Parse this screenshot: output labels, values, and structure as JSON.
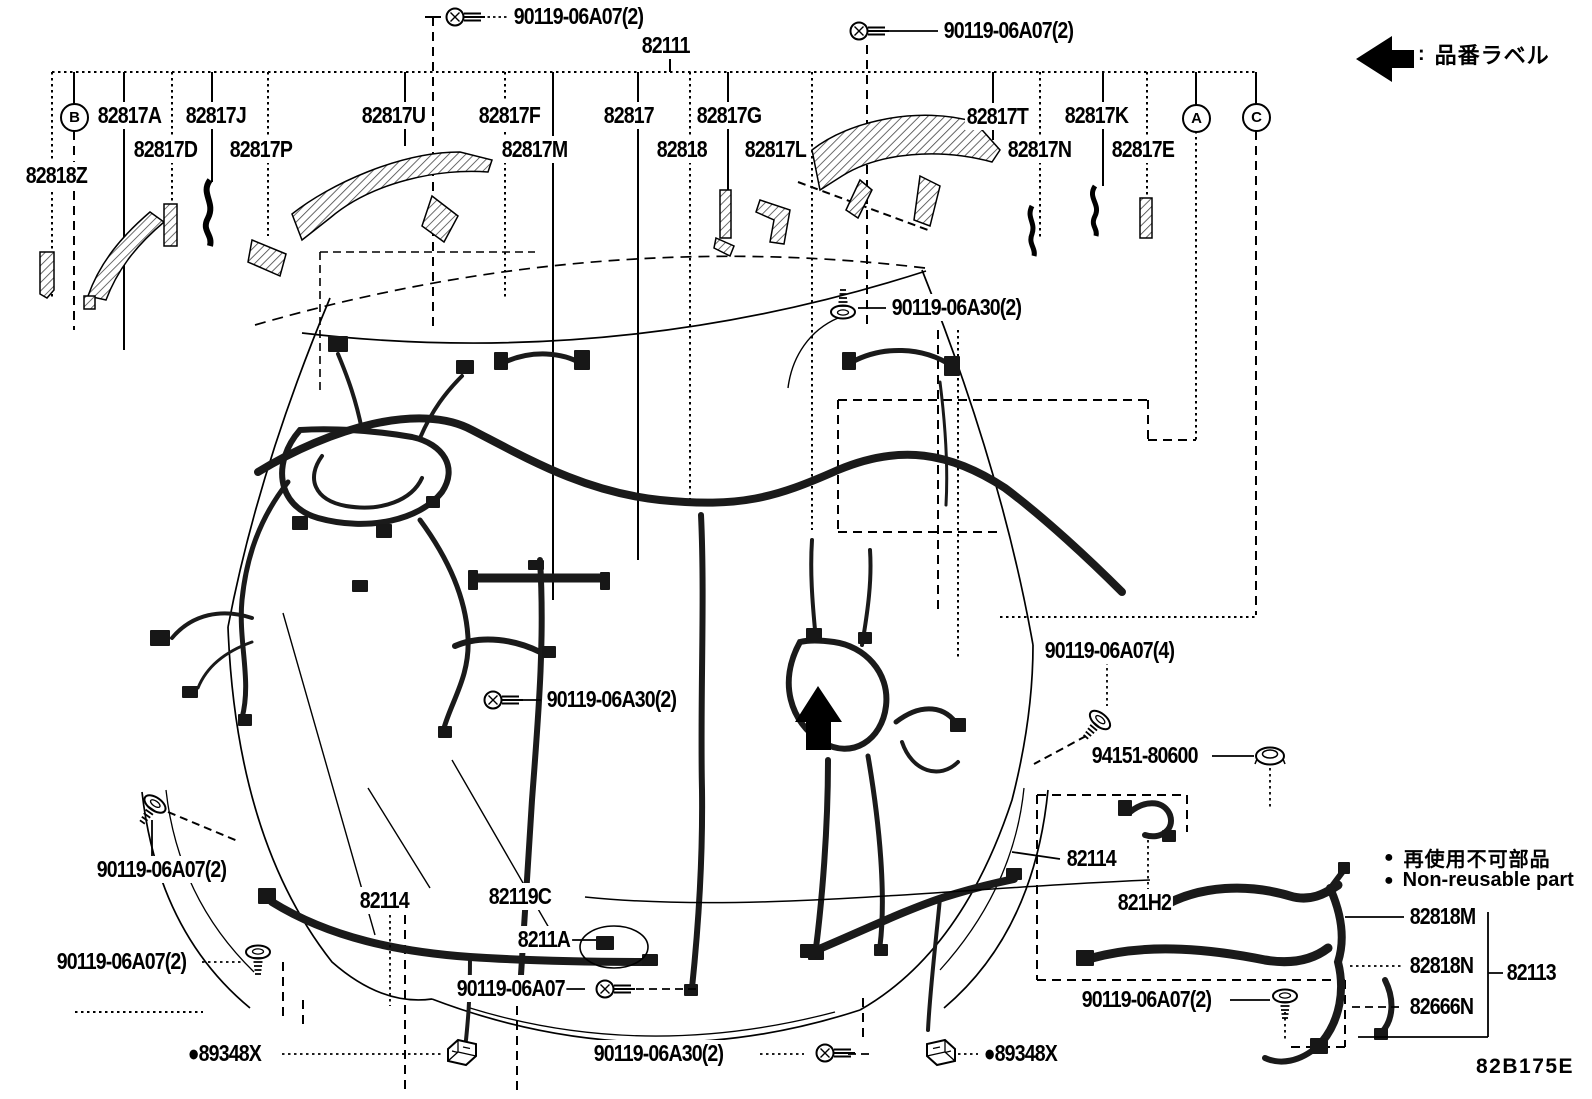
{
  "diagram_code": "82B175E",
  "legend": {
    "colon": ":",
    "label": "品番ラベル"
  },
  "nonreusable": {
    "bullet": "●",
    "jp": "再使用不可部品",
    "en": "Non-reusable part"
  },
  "circles": [
    {
      "t": "B",
      "x": 74,
      "y": 117
    },
    {
      "t": "A",
      "x": 1196,
      "y": 118
    },
    {
      "t": "C",
      "x": 1256,
      "y": 117
    }
  ],
  "labels": [
    {
      "t": "90119-06A07(2)",
      "x": 512,
      "y": 17
    },
    {
      "t": "90119-06A07(2)",
      "x": 942,
      "y": 31
    },
    {
      "t": "82111",
      "x": 640,
      "y": 46
    },
    {
      "t": "82817A",
      "x": 96,
      "y": 116
    },
    {
      "t": "82817J",
      "x": 184,
      "y": 116
    },
    {
      "t": "82817U",
      "x": 360,
      "y": 116
    },
    {
      "t": "82817F",
      "x": 477,
      "y": 116
    },
    {
      "t": "82817",
      "x": 602,
      "y": 116
    },
    {
      "t": "82817G",
      "x": 695,
      "y": 116
    },
    {
      "t": "82817T",
      "x": 965,
      "y": 117
    },
    {
      "t": "82817K",
      "x": 1063,
      "y": 116
    },
    {
      "t": "82817D",
      "x": 132,
      "y": 150
    },
    {
      "t": "82817P",
      "x": 228,
      "y": 150
    },
    {
      "t": "82817M",
      "x": 500,
      "y": 150
    },
    {
      "t": "82818",
      "x": 655,
      "y": 150
    },
    {
      "t": "82817L",
      "x": 743,
      "y": 150
    },
    {
      "t": "82817N",
      "x": 1006,
      "y": 150
    },
    {
      "t": "82817E",
      "x": 1110,
      "y": 150
    },
    {
      "t": "82818Z",
      "x": 24,
      "y": 176
    },
    {
      "t": "90119-06A30(2)",
      "x": 890,
      "y": 308
    },
    {
      "t": "90119-06A30(2)",
      "x": 545,
      "y": 700
    },
    {
      "t": "90119-06A07(4)",
      "x": 1043,
      "y": 651
    },
    {
      "t": "94151-80600",
      "x": 1090,
      "y": 756
    },
    {
      "t": "90119-06A07(2)",
      "x": 95,
      "y": 870
    },
    {
      "t": "82114",
      "x": 358,
      "y": 901
    },
    {
      "t": "82119C",
      "x": 487,
      "y": 897
    },
    {
      "t": "8211A",
      "x": 516,
      "y": 940
    },
    {
      "t": "90119-06A07",
      "x": 455,
      "y": 989
    },
    {
      "t": "90119-06A07(2)",
      "x": 55,
      "y": 962
    },
    {
      "t": "●89348X",
      "x": 186,
      "y": 1054
    },
    {
      "t": "90119-06A30(2)",
      "x": 592,
      "y": 1054
    },
    {
      "t": "●89348X",
      "x": 982,
      "y": 1054
    },
    {
      "t": "82114",
      "x": 1065,
      "y": 859
    },
    {
      "t": "821H2",
      "x": 1116,
      "y": 903
    },
    {
      "t": "90119-06A07(2)",
      "x": 1080,
      "y": 1000
    },
    {
      "t": "82818M",
      "x": 1408,
      "y": 917
    },
    {
      "t": "82818N",
      "x": 1408,
      "y": 966
    },
    {
      "t": "82666N",
      "x": 1408,
      "y": 1007
    },
    {
      "t": "82113",
      "x": 1505,
      "y": 973
    }
  ]
}
